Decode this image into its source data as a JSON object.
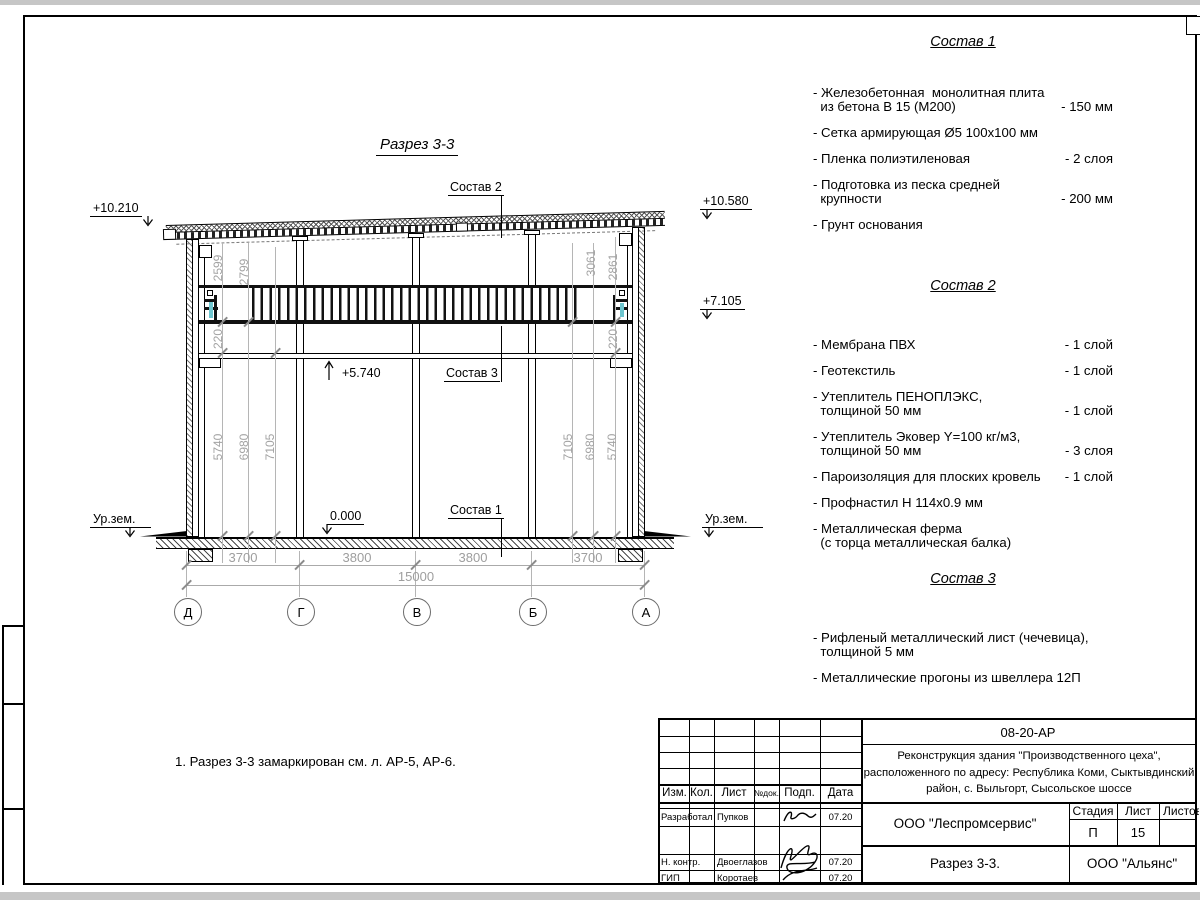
{
  "sheet": {
    "drawing_title": "Разрез 3-3",
    "note": "1. Разрез 3-3 замаркирован см. л. АР-5, АР-6."
  },
  "drawing": {
    "elevations": {
      "top_left": "+10.210",
      "top_right": "+10.580",
      "mid_right": "+7.105",
      "floor2": "+5.740",
      "zero": "0.000",
      "ground_left": "Ур.зем.",
      "ground_right": "Ур.зем."
    },
    "leaders": {
      "s1": "Состав 1",
      "s2": "Состав 2",
      "s3": "Состав 3"
    },
    "v_dims_left": [
      "2599",
      "2799",
      "220",
      "5740",
      "6980",
      "7105"
    ],
    "v_dims_right": [
      "3061",
      "2861",
      "220",
      "7105",
      "6980",
      "5740"
    ],
    "h_dims": [
      "3700",
      "3800",
      "3800",
      "3700"
    ],
    "h_dim_total": "15000",
    "axes": [
      "Д",
      "Г",
      "В",
      "Б",
      "А"
    ]
  },
  "compositions": [
    {
      "title": "Состав 1",
      "items": [
        {
          "lines": [
            "- Железобетонная  монолитная плита",
            "  из бетона В 15 (М200)"
          ],
          "qty": "- 150 мм"
        },
        {
          "lines": [
            "- Сетка армирующая Ø5 100х100 мм"
          ],
          "qty": ""
        },
        {
          "lines": [
            "- Пленка полиэтиленовая"
          ],
          "qty": "-  2 слоя"
        },
        {
          "lines": [
            "- Подготовка из песка средней",
            "  крупности"
          ],
          "qty": "- 200 мм"
        },
        {
          "lines": [
            "- Грунт основания"
          ],
          "qty": ""
        }
      ]
    },
    {
      "title": "Состав 2",
      "items": [
        {
          "lines": [
            "- Мембрана ПВХ"
          ],
          "qty": "- 1 слой"
        },
        {
          "lines": [
            "- Геотекстиль"
          ],
          "qty": "- 1 слой"
        },
        {
          "lines": [
            "- Утеплитель ПЕНОПЛЭКС,",
            "  толщиной 50 мм"
          ],
          "qty": "- 1 слой"
        },
        {
          "lines": [
            "- Утеплитель Эковер Y=100 кг/м3,",
            "  толщиной 50 мм"
          ],
          "qty": "- 3 слоя"
        },
        {
          "lines": [
            "- Пароизоляция для плоских кровель"
          ],
          "qty": "- 1 слой"
        },
        {
          "lines": [
            "- Профнастил Н 114х0.9 мм"
          ],
          "qty": ""
        },
        {
          "lines": [
            "- Металлическая ферма",
            "  (с торца металлическая балка)"
          ],
          "qty": ""
        }
      ]
    },
    {
      "title": "Состав 3",
      "items": [
        {
          "lines": [
            "- Рифленый металлический лист (чечевица),",
            "  толщиной 5 мм"
          ],
          "qty": ""
        },
        {
          "lines": [
            "- Металлические прогоны из швеллера 12П"
          ],
          "qty": ""
        }
      ]
    }
  ],
  "title_block": {
    "doc_number": "08-20-АР",
    "project": [
      "Реконструкция здания \"Производственного цеха\",",
      "расположенного по адресу: Республика Коми, Сыктывдинский",
      "район, с. Выльгорт, Сысольское шоссе"
    ],
    "org_design": "ООО \"Леспромсервис\"",
    "sheet_title": "Разрез 3-3.",
    "org_customer": "ООО \"Альянс\"",
    "stage_label": "Стадия",
    "sheet_label": "Лист",
    "sheets_label": "Листов",
    "stage": "П",
    "sheet": "15",
    "sheets": "",
    "cols": {
      "izm": "Изм.",
      "kol": "Кол.",
      "list": "Лист",
      "ndoc": "№док.",
      "podp": "Подп.",
      "data": "Дата"
    },
    "rows": [
      {
        "role": "Разработал",
        "name": "Пупков",
        "date": "07.20"
      },
      {
        "role": "Н. контр.",
        "name": "Двоеглазов",
        "date": "07.20"
      },
      {
        "role": "ГИП",
        "name": "Коротаев",
        "date": "07.20"
      }
    ]
  }
}
